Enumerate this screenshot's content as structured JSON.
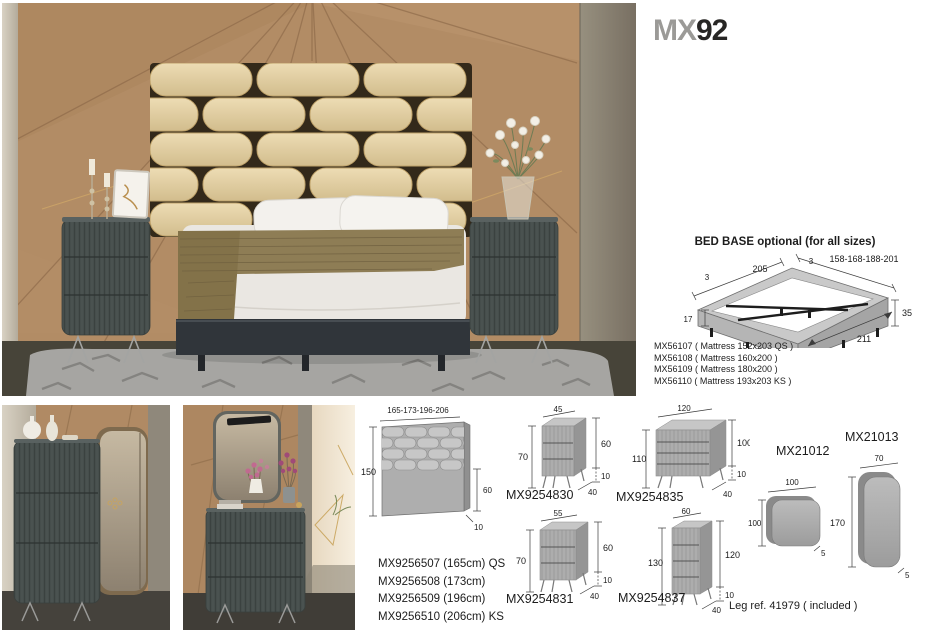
{
  "title": {
    "prefix": "MX",
    "number": "92"
  },
  "bed_base": {
    "heading": "BED BASE optional (for all sizes)",
    "dims": {
      "rim_left": "3",
      "length": "205",
      "rim_right": "3",
      "widths": "158-168-188-201",
      "height_front": "17",
      "height_back": "35",
      "depth": "211"
    },
    "models": [
      "MX56107 ( Mattress 152x203 QS )",
      "MX56108 ( Mattress 160x200 )",
      "MX56109 ( Mattress 180x200 )",
      "MX56110 ( Mattress 193x203 KS )"
    ]
  },
  "headboard": {
    "dims": {
      "widths": "165-173-196-206",
      "height": "150",
      "panel_height": "60",
      "depth": "10"
    },
    "models": [
      "MX9256507 (165cm) QS",
      "MX9256508 (173cm)",
      "MX9256509 (196cm)",
      "MX9256510 (206cm) KS"
    ]
  },
  "nightstand_small": {
    "label": "MX9254830",
    "dims": {
      "width": "45",
      "height": "70",
      "body_height": "60",
      "leg_height": "10",
      "depth": "40"
    }
  },
  "dresser": {
    "label": "MX9254835",
    "dims": {
      "width": "120",
      "height": "110",
      "body_height": "100",
      "leg_height": "10",
      "depth": "40"
    }
  },
  "nightstand_large": {
    "label": "MX9254831",
    "dims": {
      "width": "55",
      "height": "70",
      "body_height": "60",
      "leg_height": "10",
      "depth": "40"
    }
  },
  "tall_chest": {
    "label": "MX9254837",
    "dims": {
      "width": "60",
      "height": "130",
      "body_height": "120",
      "leg_height": "10",
      "depth": "40"
    }
  },
  "mirror_square": {
    "label": "MX21012",
    "dims": {
      "width": "100",
      "height": "100",
      "depth": "5"
    }
  },
  "mirror_tall": {
    "label": "MX21013",
    "dims": {
      "width": "70",
      "height": "170",
      "depth": "5"
    }
  },
  "footer": {
    "leg_note": "Leg ref. 41979 ( included )"
  },
  "palette": {
    "furniture_dark": "#4a5250",
    "headboard_beige": "#e3d2a8",
    "wood": "#b08a64",
    "drawing_gray": "#a9a9a9"
  }
}
